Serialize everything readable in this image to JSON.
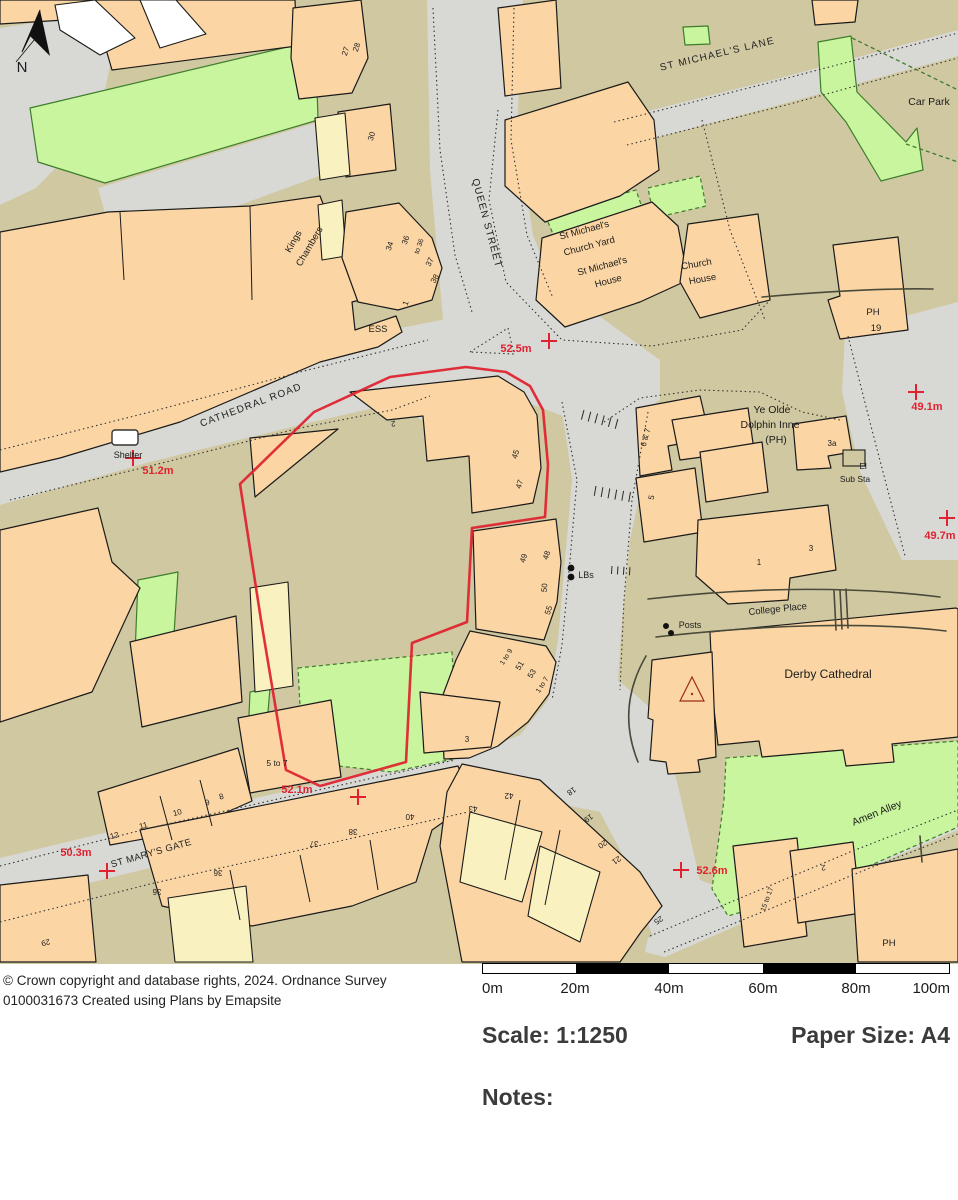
{
  "map": {
    "north": "N",
    "roads": {
      "queen_street": "QUEEN STREET",
      "cathedral_road": "CATHEDRAL ROAD",
      "st_michaels_lane": "ST MICHAEL'S LANE",
      "st_marys_gate": "ST MARY'S GATE",
      "college_place": "College Place",
      "amen_alley": "Amen Alley"
    },
    "places": {
      "kings_1": "Kings",
      "kings_2": "Chambers",
      "car_park": "Car Park",
      "church_yard_1": "St Michael's",
      "church_yard_2": "Church Yard",
      "st_michaels_house_1": "St Michael's",
      "st_michaels_house_2": "House",
      "church_house_1": "Church",
      "church_house_2": "House",
      "ph_north": "PH",
      "no_19": "19",
      "ess": "ESS",
      "shelter": "Shelter",
      "dolphin_1": "Ye Olde",
      "dolphin_2": "Dolphin Inne",
      "dolphin_3": "(PH)",
      "el": "El",
      "sub_sta": "Sub Sta",
      "posts": "Posts",
      "lbs": "LBs",
      "cathedral": "Derby Cathedral",
      "ph_south": "PH"
    },
    "spot_heights": {
      "h1": "52.5m",
      "h2": "51.2m",
      "h3": "49.1m",
      "h4": "49.7m",
      "h5": "52.1m",
      "h6": "50.3m",
      "h7": "52.6m"
    },
    "numbers": {
      "n27": "27",
      "n28": "28",
      "n30": "30",
      "n34": "34",
      "n36": "36",
      "to36": "to 36",
      "n37": "37",
      "n38": "38",
      "n1_ess": "1",
      "n2_site": "2",
      "n45": "45",
      "n47": "47",
      "n49": "49",
      "n48": "48",
      "n50": "50",
      "n55": "55",
      "r1to9": "1 to 9",
      "n51": "51",
      "n53": "53",
      "r1to7": "1 to 7",
      "n3_site": "3",
      "n6_7": "6 & 7",
      "n5": "5",
      "n3a": "3a",
      "n1_dol": "1",
      "n3_dol": "3",
      "n5to7": "5 to 7",
      "n8": "8",
      "n9": "9",
      "n10": "10",
      "n11": "11",
      "n12": "12",
      "n29": "29",
      "n36a": "36",
      "n36b": "36",
      "n37s": "37",
      "n38s": "38",
      "n40": "40",
      "n42": "42",
      "n43": "43",
      "n18": "18",
      "n19": "19",
      "n20": "20",
      "n21": "21",
      "n25": "25",
      "n15to17": "15 to 17",
      "n2_se": "2"
    }
  },
  "footer": {
    "copyright_1": "© Crown copyright and database rights, 2024. Ordnance Survey",
    "copyright_2": "0100031673 Created using Plans by Emapsite",
    "scalebar_ticks": [
      "0m",
      "20m",
      "40m",
      "60m",
      "80m",
      "100m"
    ],
    "scale": "Scale: 1:1250",
    "paper": "Paper Size: A4",
    "notes": "Notes:"
  }
}
